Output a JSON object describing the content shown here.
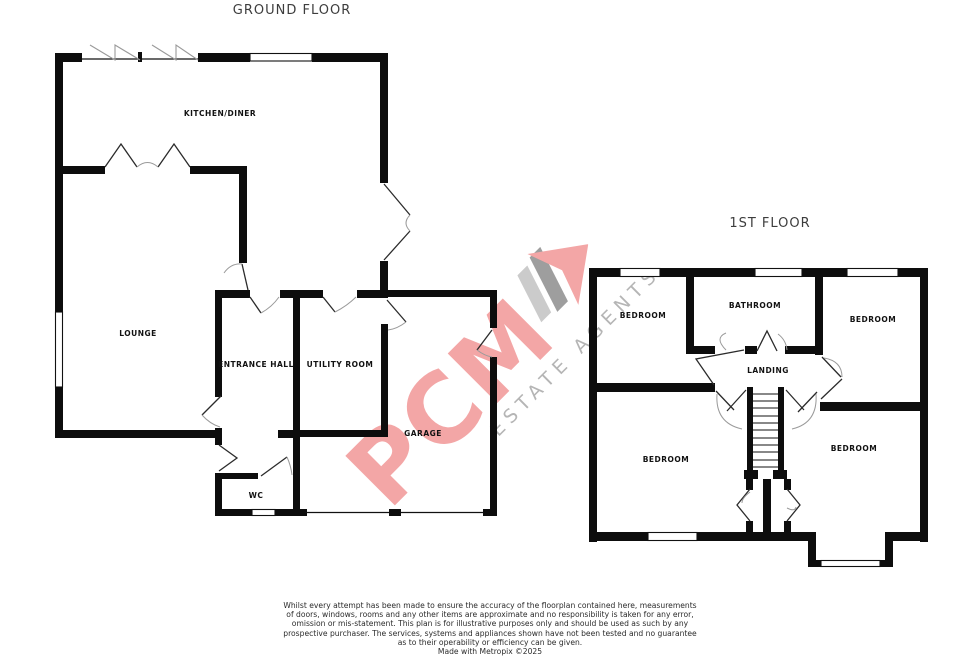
{
  "ground_floor": {
    "title": "GROUND FLOOR",
    "rooms": {
      "kitchen": "KITCHEN/DINER",
      "lounge": "LOUNGE",
      "entrance_hall": "ENTRANCE HALL",
      "utility": "UTILITY ROOM",
      "garage": "GARAGE",
      "wc": "WC"
    }
  },
  "first_floor": {
    "title": "1ST FLOOR",
    "rooms": {
      "bedroom_top_left": "BEDROOM",
      "bathroom": "BATHROOM",
      "bedroom_top_right": "BEDROOM",
      "bedroom_bottom_left": "BEDROOM",
      "bedroom_bottom_right": "BEDROOM",
      "landing": "LANDING"
    }
  },
  "watermark": {
    "name": "PCM",
    "tagline": "ESTATE AGENTS",
    "brand_color": "#f3a6a6",
    "tagline_color": "#b5b5b5"
  },
  "colors": {
    "wall": "#0d0d0d",
    "door_line": "#2b2b2b",
    "swing_arc": "#9a9a9a"
  },
  "disclaimer": {
    "lines": [
      "Whilst every attempt has been made to ensure the accuracy of the floorplan contained here, measurements",
      "of doors, windows, rooms and any other items are approximate and no responsibility is taken for any error,",
      "omission or mis-statement. This plan is for illustrative purposes only and should be used as such by any",
      "prospective purchaser. The services, systems and appliances shown have not been tested and no guarantee",
      "as to their operability or efficiency can be given.",
      "Made with Metropix ©2025"
    ]
  }
}
